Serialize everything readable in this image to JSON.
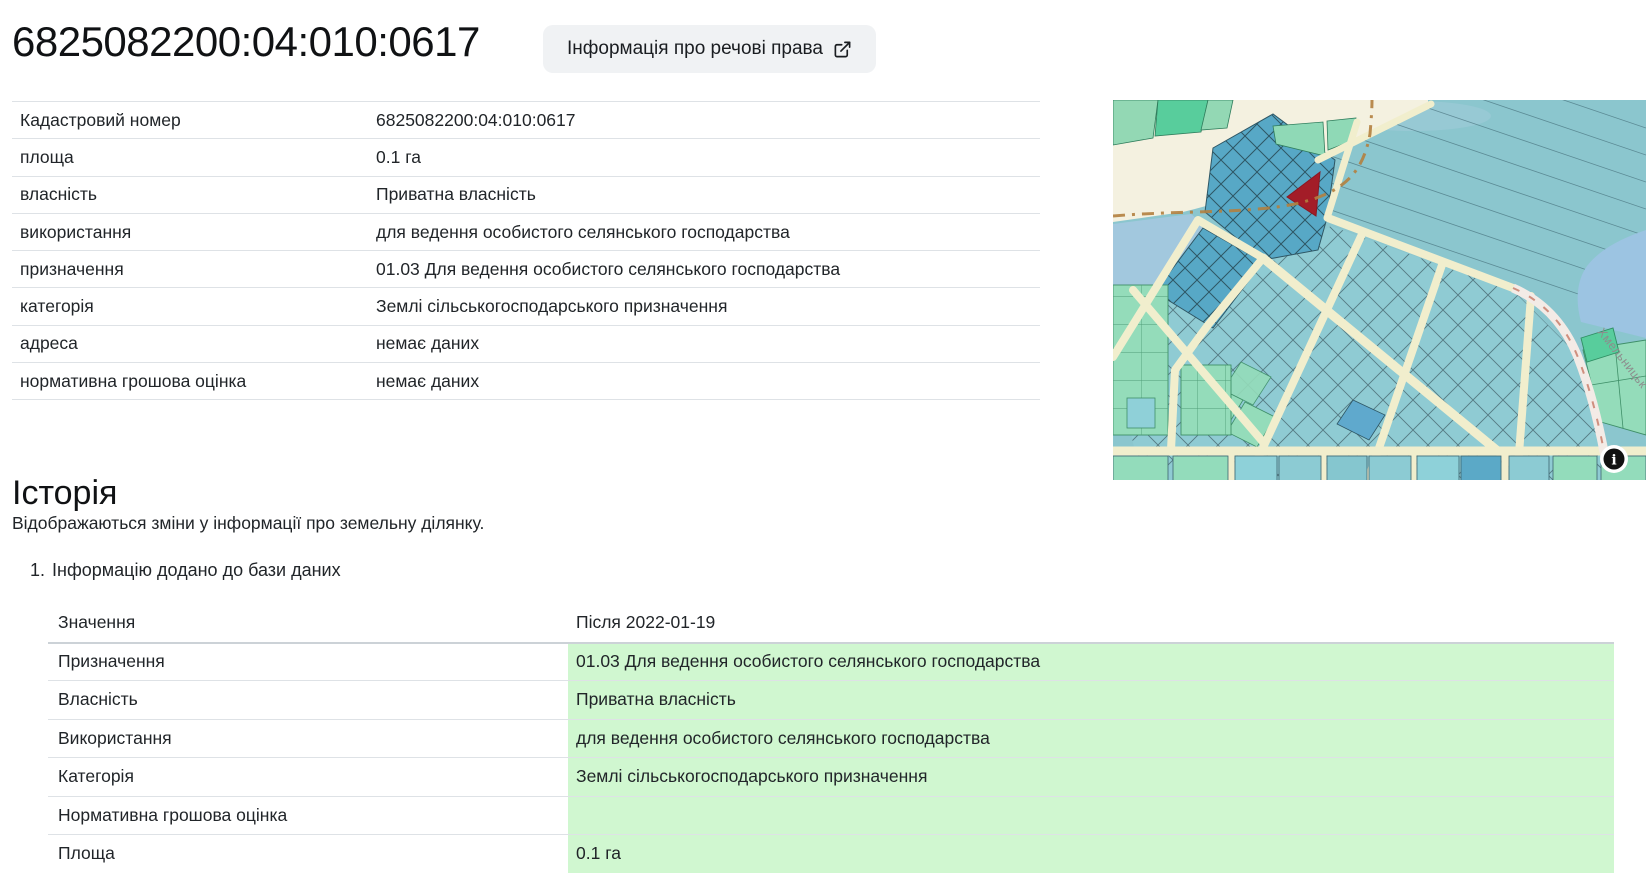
{
  "header": {
    "title": "6825082200:04:010:0617",
    "rights_button_label": "Інформація про речові права",
    "rights_button_icon": "external-link-icon"
  },
  "info_table": {
    "rows": [
      {
        "label": "Кадастровий номер",
        "value": "6825082200:04:010:0617"
      },
      {
        "label": "площа",
        "value": "0.1 га"
      },
      {
        "label": "власність",
        "value": "Приватна власність"
      },
      {
        "label": "використання",
        "value": "для ведення особистого селянського господарства"
      },
      {
        "label": "призначення",
        "value": "01.03 Для ведення особистого селянського господарства"
      },
      {
        "label": "категорія",
        "value": "Землі сільськогосподарського призначення"
      },
      {
        "label": "адреса",
        "value": "немає даних"
      },
      {
        "label": "нормативна грошова оцінка",
        "value": "немає даних"
      }
    ]
  },
  "map": {
    "street_label": "Хмельницьк",
    "attribution_icon": "info-icon",
    "attribution_glyph": "i",
    "selected_parcel_color": "#a31d28",
    "colors": {
      "base_teal": "#8bc6ce",
      "dark_parcel_blue": "#57a8c6",
      "road_cream": "#f1eecd",
      "green_parcel": "#94dcba",
      "bright_green_parcel": "#58cd9c",
      "water_blue": "#9cc4e2",
      "dashed_boundary_brown": "#b27f3f"
    }
  },
  "history": {
    "title": "Історія",
    "subtitle": "Відображаються зміни у інформації про земельну ділянку.",
    "entries": [
      {
        "number": "1.",
        "title": "Інформацію додано до бази даних",
        "rows": [
          {
            "label": "Значення",
            "value": "Після 2022-01-19"
          },
          {
            "label": "Призначення",
            "value": "01.03 Для ведення особистого селянського господарства"
          },
          {
            "label": "Власність",
            "value": "Приватна власність"
          },
          {
            "label": "Використання",
            "value": "для ведення особистого селянського господарства"
          },
          {
            "label": "Категорія",
            "value": "Землі сільськогосподарського призначення"
          },
          {
            "label": "Нормативна грошова оцінка",
            "value": ""
          },
          {
            "label": "Площа",
            "value": "0.1 га"
          }
        ]
      }
    ],
    "highlight_color": "#d0f7d0"
  }
}
